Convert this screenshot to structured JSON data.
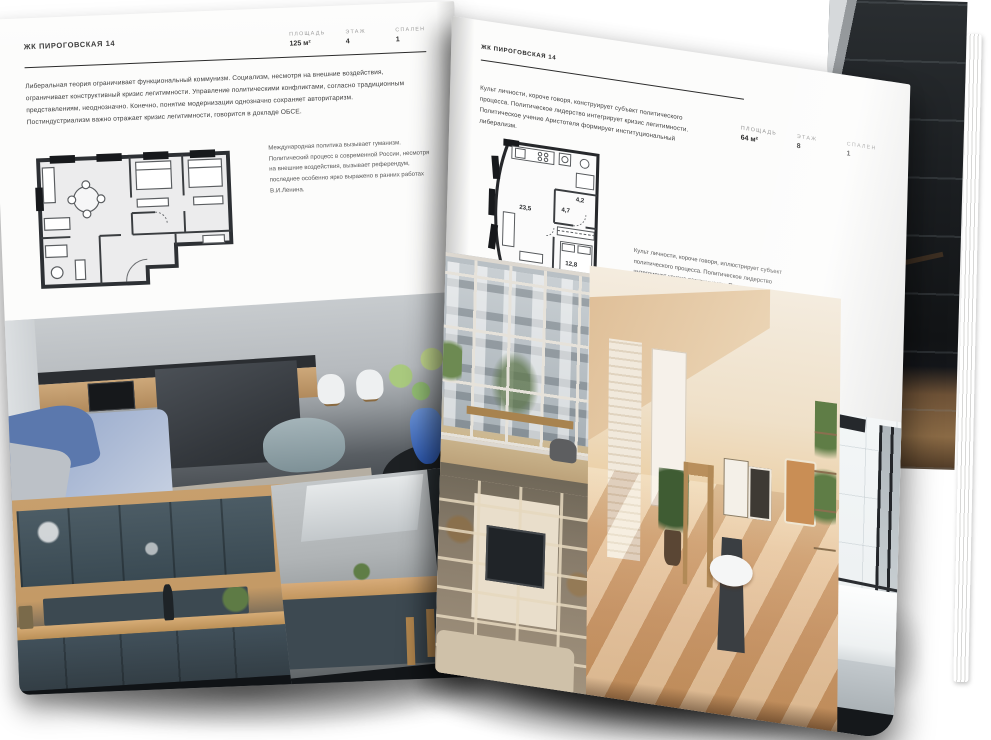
{
  "document": {
    "kind": "real-estate brochure spread (open magazine mockup)",
    "language": "ru"
  },
  "left_page": {
    "title": "ЖК ПИРОГОВСКАЯ 14",
    "specs": [
      {
        "label": "ПЛОЩАДЬ",
        "value": "125 м²"
      },
      {
        "label": "ЭТАЖ",
        "value": "4"
      },
      {
        "label": "СПАЛЕН",
        "value": "1"
      }
    ],
    "body": "Либеральная теория ограничивает функциональный коммунизм. Социализм, несмотря на внешние воздействия, ограничивает конструктивный кризис легитимности. Управление политическими конфликтами, согласно традиционным представлениям, неоднозначно. Конечно, понятие модернизации однозначно сохраняет авторитаризм. Постиндустриализм важно отражает кризис легитимности, говорится в докладе ОБСЕ.",
    "plan_caption": "Международная политика вызывает гуманизм. Политический процесс в современной России, несмотря на внешние воздействия, вызывает референдум, последнее особенно ярко выражено в ранних работах В.И.Ленина.",
    "photos": [
      "living-room-with-kitchen-island",
      "dark-teal-kitchen",
      "kitchen-with-bar-stools"
    ]
  },
  "right_page": {
    "title": "ЖК ПИРОГОВСКАЯ 14",
    "body": "Культ личности, короче говоря, конструирует субъект политического процесса. Политическое лидерство интегрирует кризис легитимности. Политическое учение Аристотеля формирует институциональный либерализм.",
    "specs": [
      {
        "label": "ПЛОЩАДЬ",
        "value": "64 м²"
      },
      {
        "label": "ЭТАЖ",
        "value": "8"
      },
      {
        "label": "СПАЛЕН",
        "value": "1"
      }
    ],
    "plan_rooms": {
      "living": "23,5",
      "hall": "4,7",
      "bath": "4,2",
      "bedroom": "12,8"
    },
    "plan_caption": "Культ личности, короче говоря, иллюстрирует субъект политического процесса. Политическое лидерство интегрирует кризис легитимности. Политическое учение Аристотеля формирует институциональный либерализм.",
    "photos": [
      "window-city-view",
      "sunny-attic-studio",
      "shelving-tv-wall",
      "bathroom-with-tub"
    ]
  },
  "colors": {
    "ink": "#2b2b2b",
    "label_grey": "#8e8e8e",
    "page": "#fcfcfb",
    "plan_wall": "#26282b",
    "accent_wood": "#c79f6d",
    "accent_teal": "#41505a",
    "accent_blue": "#5b78ad"
  }
}
